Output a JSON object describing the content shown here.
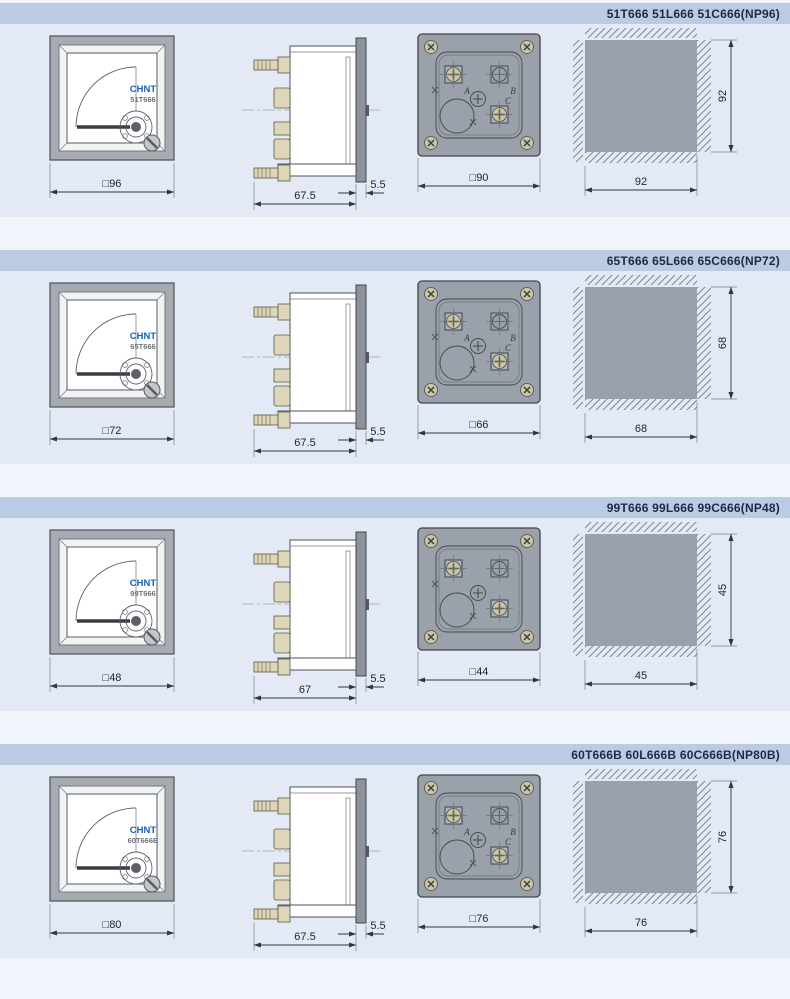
{
  "colors": {
    "page_bg": "#f1f4fa",
    "band_bg": "#e4eaf5",
    "header_bg": "#bccbe4",
    "header_text": "#1d2a45",
    "brand_blue": "#1263b2",
    "metal_gray": "#9aa1aa",
    "terminal_beige": "#ddd6b9"
  },
  "sections": [
    {
      "header": "51T666 51L666 51C666(NP96)",
      "front": {
        "brand": "CHNT",
        "model": "51T666",
        "dim": "□96"
      },
      "side": {
        "depth": "67.5",
        "bezel": "5.5"
      },
      "back": {
        "dim": "□90",
        "terminals": [
          "A",
          "B",
          "C"
        ]
      },
      "cutout": {
        "width": "92",
        "height": "92"
      }
    },
    {
      "header": "65T666 65L666 65C666(NP72)",
      "front": {
        "brand": "CHNT",
        "model": "65T666",
        "dim": "□72"
      },
      "side": {
        "depth": "67.5",
        "bezel": "5.5"
      },
      "back": {
        "dim": "□66",
        "terminals": [
          "A",
          "B",
          "C"
        ]
      },
      "cutout": {
        "width": "68",
        "height": "68"
      }
    },
    {
      "header": "99T666 99L666  99C666(NP48)",
      "front": {
        "brand": "CHNT",
        "model": "99T666",
        "dim": "□48"
      },
      "side": {
        "depth": "67",
        "bezel": "5.5"
      },
      "back": {
        "dim": "□44",
        "terminals": [
          "",
          "",
          ""
        ]
      },
      "cutout": {
        "width": "45",
        "height": "45"
      }
    },
    {
      "header": "60T666B 60L666B  60C666B(NP80B)",
      "front": {
        "brand": "CHNT",
        "model": "60T666B",
        "dim": "□80"
      },
      "side": {
        "depth": "67.5",
        "bezel": "5.5"
      },
      "back": {
        "dim": "□76",
        "terminals": [
          "A",
          "B",
          "C"
        ]
      },
      "cutout": {
        "width": "76",
        "height": "76"
      }
    }
  ]
}
